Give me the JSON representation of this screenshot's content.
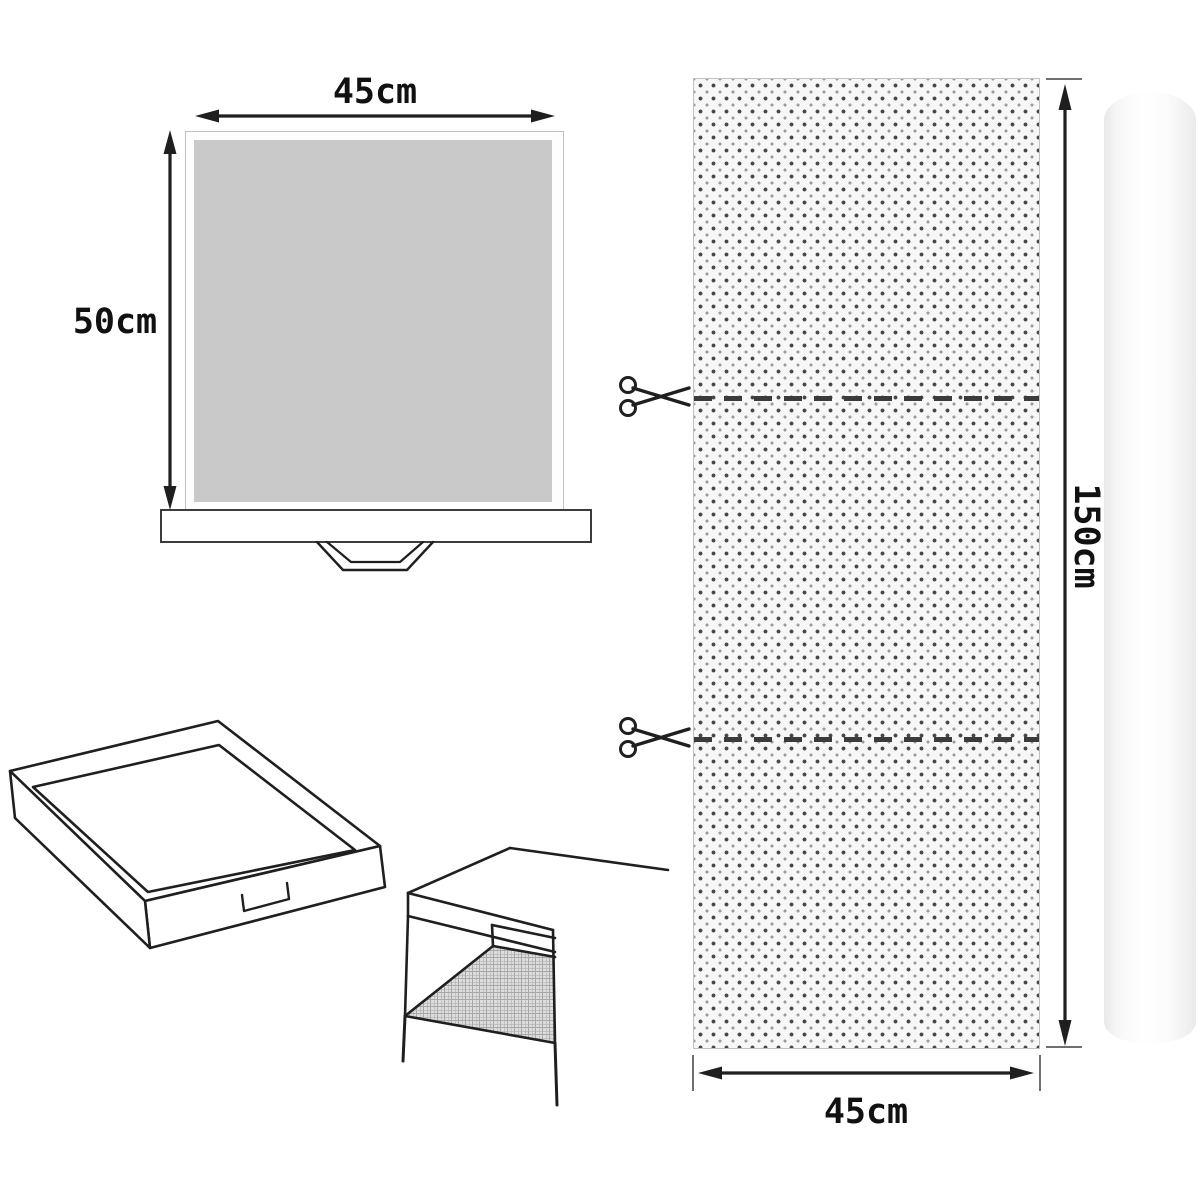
{
  "diagram": {
    "front_view": {
      "width_label": "45cm",
      "height_label": "50cm"
    },
    "roll_view": {
      "length_label": "150cm",
      "width_label": "45cm"
    }
  },
  "icons": {
    "scissors": "scissors-icon",
    "arrows": "double-headed-arrow"
  },
  "colors": {
    "liner_fill": "#c9c9c9",
    "panel_bg": "#f7f7f7",
    "panel_border": "#c2c2c2",
    "dot_dark": "#474747",
    "dot_light": "#9a9a9a",
    "line": "#1f1f1f",
    "hatch_bg": "#dddddd",
    "hatch_line": "#a8a8a8",
    "tick": "#6f6f6f"
  }
}
